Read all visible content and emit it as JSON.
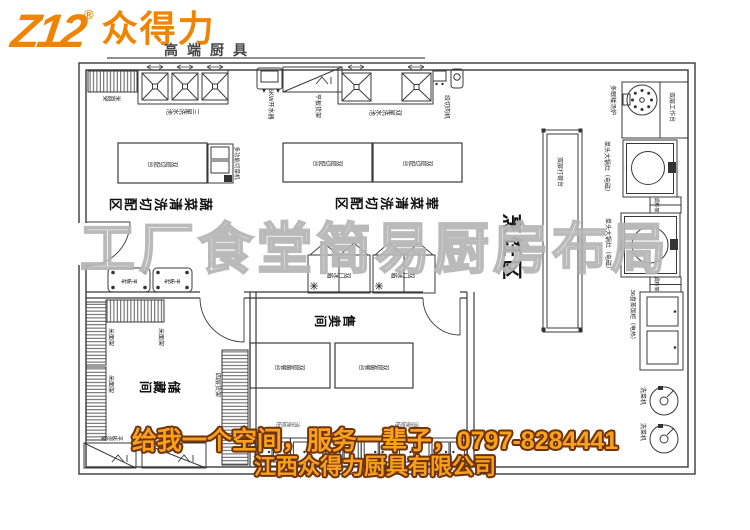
{
  "logo": {
    "mark": "Z12",
    "registered": "®",
    "name": "众得力",
    "tagline": "高端厨具"
  },
  "watermark": "工厂食堂简易厨房布局",
  "banner": {
    "line1": "给我一个空间，服务一辈子，0797-8284441",
    "line2": "江西众得力厨具有限公司"
  },
  "colors": {
    "brand_orange": "#f08300",
    "banner_fill": "#f9a11c",
    "banner_outline": "#6f3209",
    "plan_line": "#3a3a3a",
    "watermark_gray": "#b2b2b2"
  },
  "areas": {
    "cooking": "烹饪区",
    "veg": "蔬菜清洗切配区",
    "meat": "荤菜清洗切配区",
    "storage": "储藏间",
    "sales": "售卖间"
  },
  "equipment": {
    "three_star_sink": "三星洗水池",
    "two_star_sink": "双星洗水池",
    "water_boiler": "6KW开水器",
    "flat_shelf": "平板货架",
    "meat_grinder": "绞切肉机",
    "soup_stove": "多眼矮汤炉",
    "work_table": "双层工作台",
    "wok_stove": "单头大锅灶（电磁）",
    "spice_rack": "调料架",
    "rice_steamer": "36盘蒸饭柜（电热）",
    "veg_washer": "洗菜机",
    "prep_counter": "双层打荷台",
    "cut_table": "双层切配台",
    "veg_cutter": "多功能切菜机",
    "rice_rack": "米面架",
    "four_layer_rack": "四层货架",
    "flat_cart": "平板车",
    "double_door_fridge": "双门冰箱",
    "serve_table": "双层备餐台",
    "sterilize_cabinet": "消毒碗柜"
  }
}
